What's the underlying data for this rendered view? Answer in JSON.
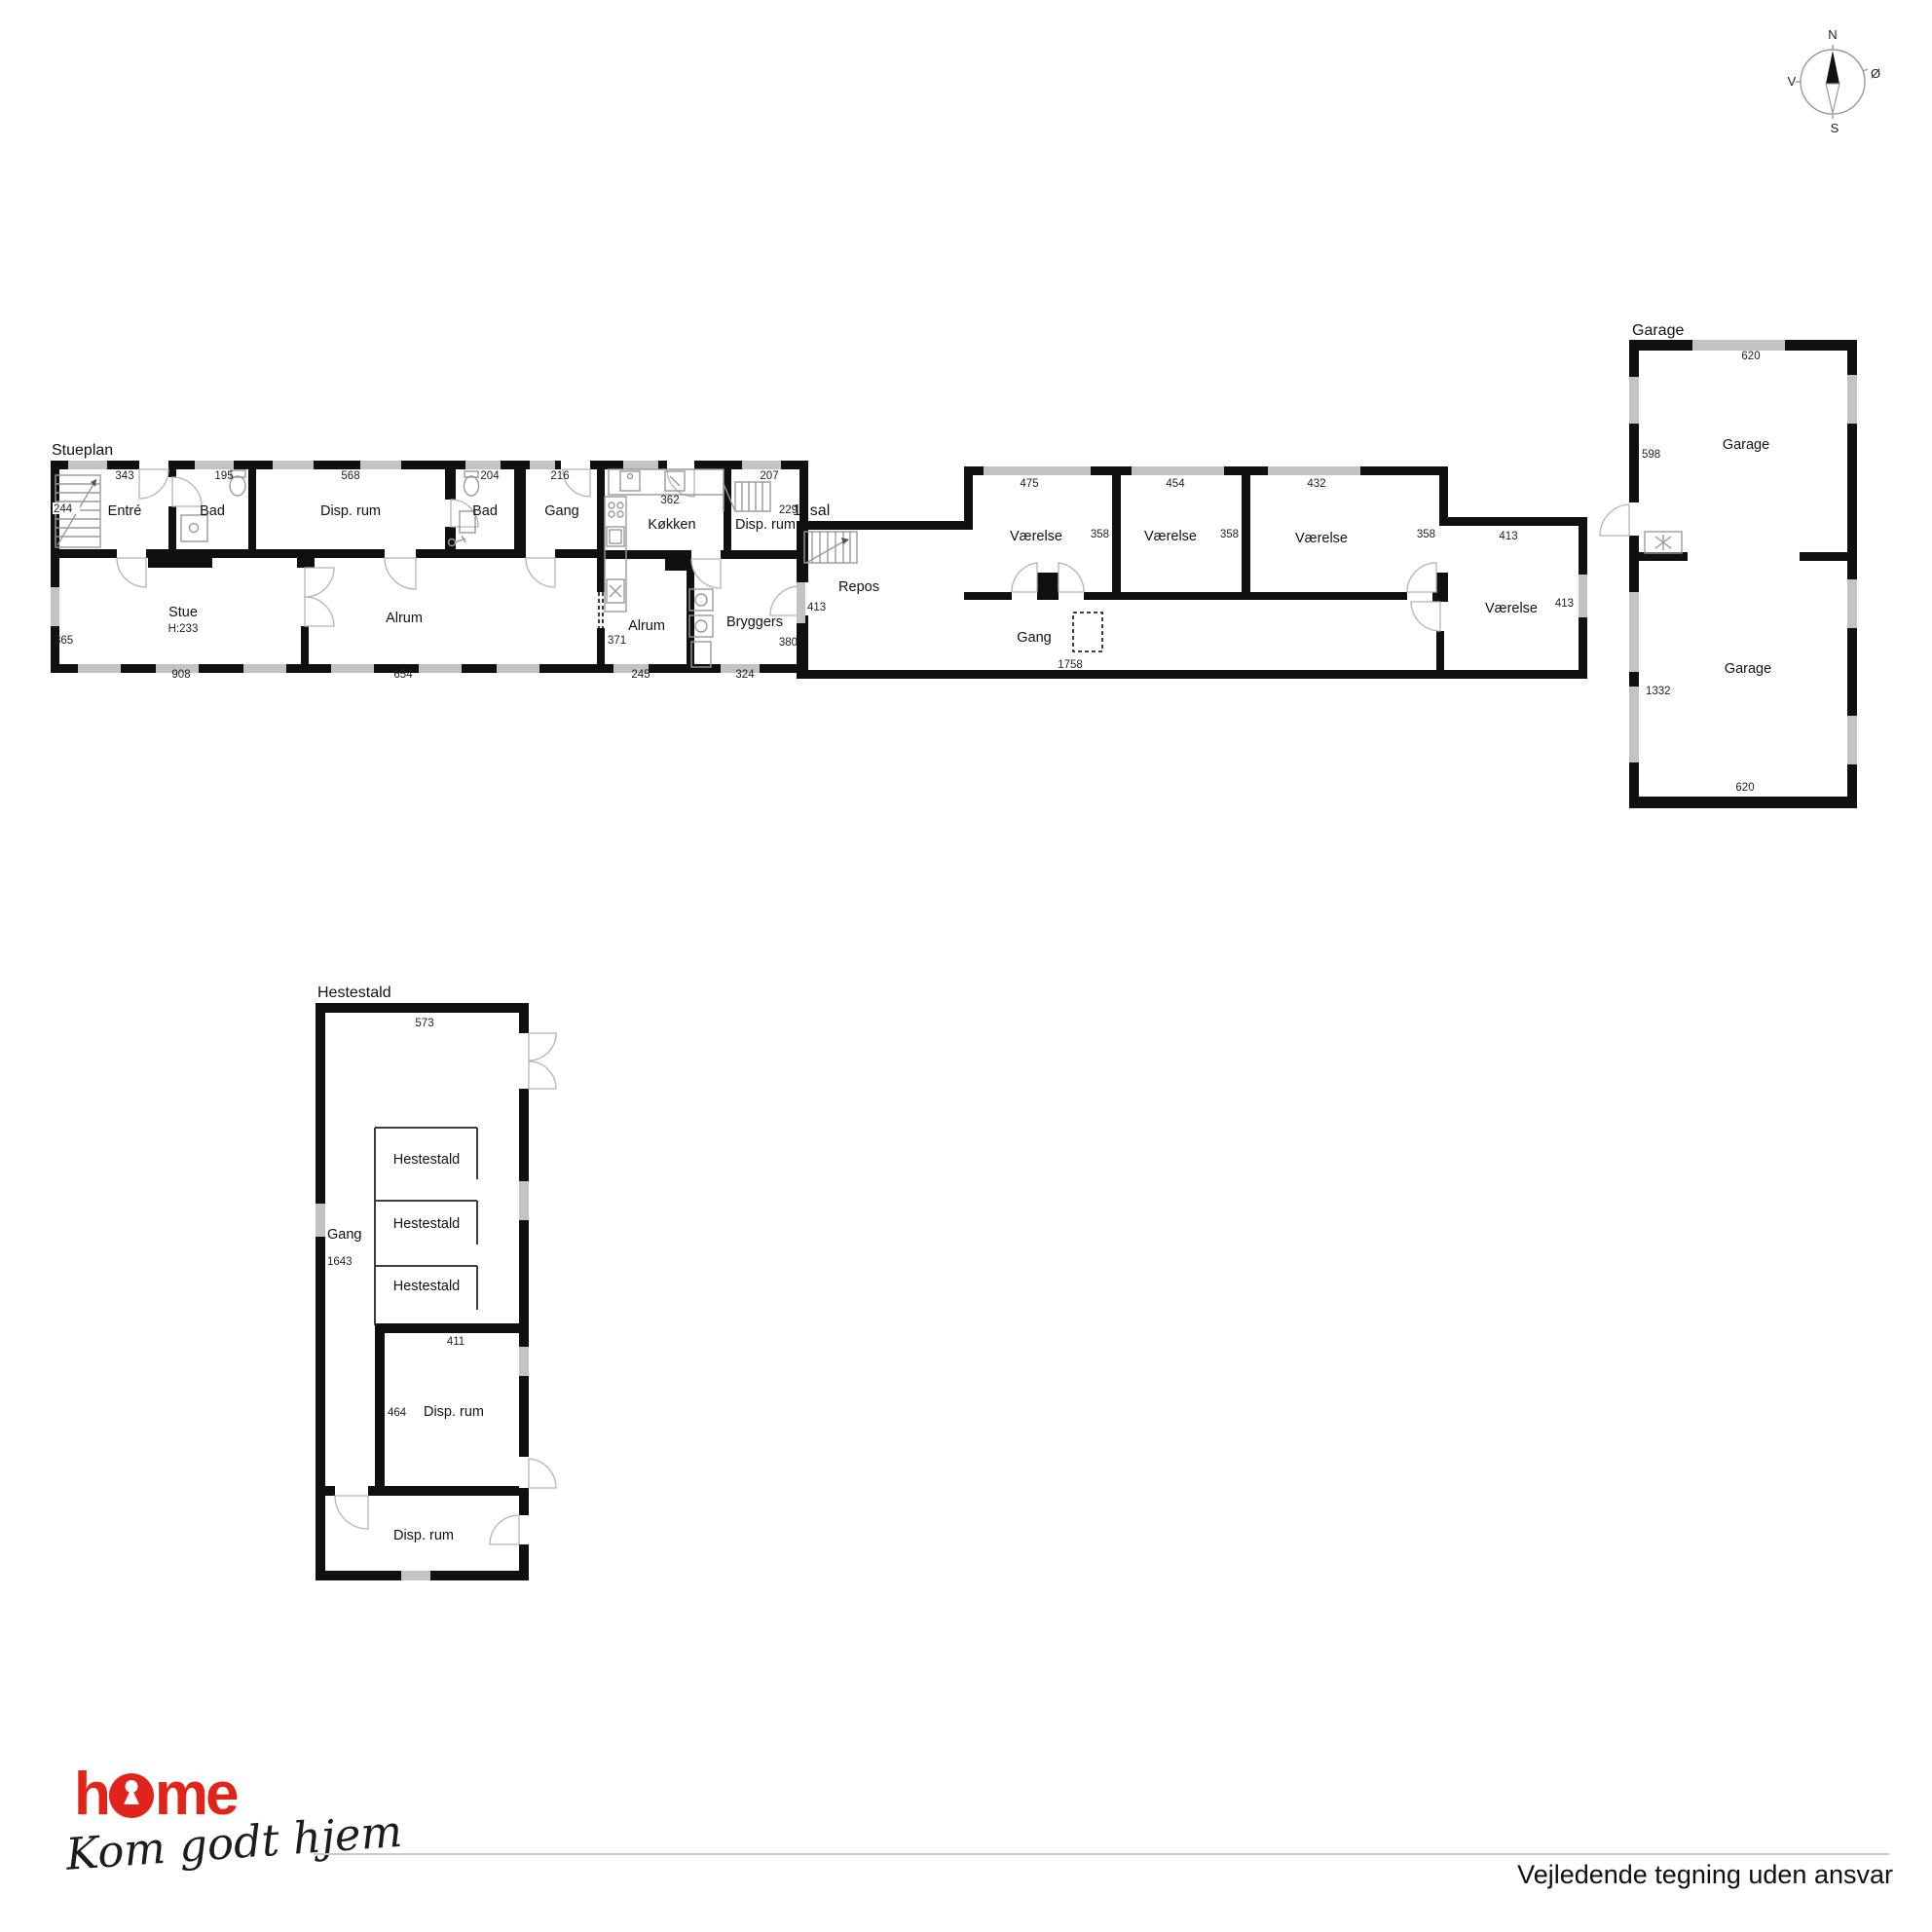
{
  "compass": {
    "north": "N",
    "south": "S",
    "west": "V",
    "east": "Ø"
  },
  "stueplan": {
    "title": "Stueplan",
    "rooms": {
      "entre": "Entré",
      "bad1": "Bad",
      "disp1": "Disp. rum",
      "bad2": "Bad",
      "gang": "Gang",
      "kokken": "Køkken",
      "disp2": "Disp. rum",
      "stue": "Stue",
      "stue_height": "H:233",
      "alrum1": "Alrum",
      "alrum2": "Alrum",
      "bryggers": "Bryggers"
    },
    "dims": {
      "d244": "244",
      "d343": "343",
      "d195": "195",
      "d568": "568",
      "d204": "204",
      "d216": "216",
      "d362": "362",
      "d207": "207",
      "d229": "229",
      "d365": "365",
      "d908": "908",
      "d654": "654",
      "d371": "371",
      "d245": "245",
      "d380": "380",
      "d324": "324"
    }
  },
  "sal1": {
    "title": "1. sal",
    "rooms": {
      "repos": "Repos",
      "v1": "Værelse",
      "v2": "Værelse",
      "v3": "Værelse",
      "v4": "Værelse",
      "gang": "Gang"
    },
    "dims": {
      "d413l": "413",
      "d475": "475",
      "d454": "454",
      "d432": "432",
      "d358a": "358",
      "d358b": "358",
      "d358c": "358",
      "d413t": "413",
      "d413r": "413",
      "d1758": "1758"
    }
  },
  "garage": {
    "title": "Garage",
    "rooms": {
      "g1": "Garage",
      "g2": "Garage"
    },
    "dims": {
      "top": "620",
      "left_upper": "598",
      "left_lower": "1332",
      "bottom": "620"
    }
  },
  "hestestald": {
    "title": "Hestestald",
    "rooms": {
      "gang": "Gang",
      "s1": "Hestestald",
      "s2": "Hestestald",
      "s3": "Hestestald",
      "disp1": "Disp. rum",
      "disp2": "Disp. rum"
    },
    "dims": {
      "top": "573",
      "left": "1643",
      "disp_top": "411",
      "disp_left": "464"
    }
  },
  "footer": {
    "logo_h": "h",
    "logo_me": "me",
    "tagline": "Kom godt hjem",
    "disclaimer": "Vejledende tegning uden ansvar"
  }
}
